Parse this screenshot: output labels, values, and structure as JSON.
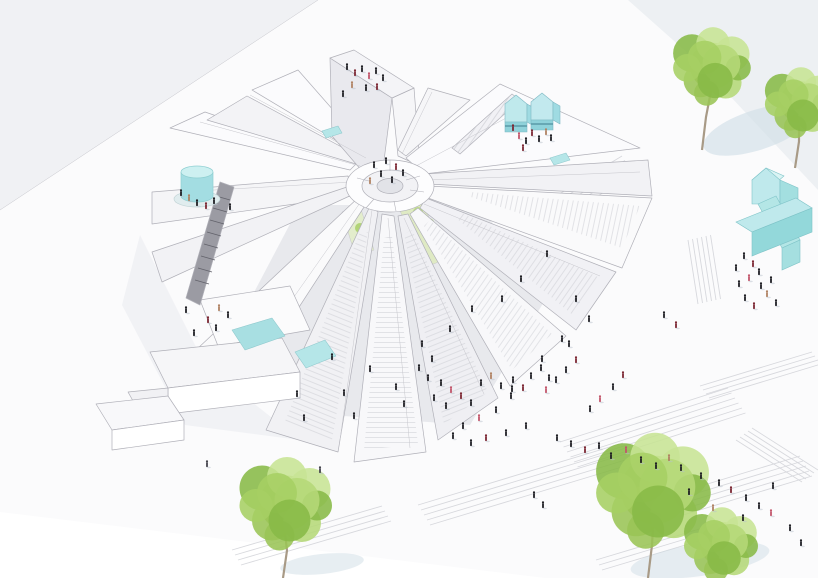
{
  "scene": {
    "description": "axonometric architectural rendering of a radial pavilion building with wedge-shaped stair roofs on a stepped public plaza, cyan rooftop volumes, green trees and scattered tiny people",
    "objects": [
      "radial-building",
      "central-hub",
      "roof-wedges",
      "stair-ramps",
      "cyan-water-tank",
      "cyan-roof-pavilions",
      "cyan-house-volume",
      "cyan-cross-volume",
      "roof-skylight-pools",
      "courtyard-green-strips",
      "plaza-terraced-steps",
      "trees",
      "tree-shadows",
      "people-figures",
      "block-steps",
      "dark-stair"
    ],
    "colors": {
      "background": "#ffffff",
      "ground_tint": "#f0f1f4",
      "ground_tint_right": "#edf0f3",
      "plaza_white": "#ffffff",
      "line": "#b0b0b8",
      "line_soft": "#c6c6cc",
      "step_line": "#d4d5da",
      "wedge_light": "#fbfbfd",
      "wedge_mid": "#f3f3f6",
      "wedge_dark": "#e9e9ee",
      "interior_shadow": "#e4e5ea",
      "accent_cyan": "#bfe9ec",
      "accent_cyan_mid": "#a3dde2",
      "accent_cyan_dark": "#8fd4d8",
      "accent_cyan_deep": "#5f9aa8",
      "pool_cyan": "#a8dfe2",
      "green_strip": "#dcead#",
      "tree_green": "#a6cf63",
      "tree_green_dark": "#88b947",
      "tree_green_light": "#c7e494",
      "trunk": "#a89a86",
      "shadow_blue": "#cfdde6",
      "person_black": "#1f1f24",
      "person_red": "#7c2733",
      "person_pink": "#c2566b",
      "person_tan": "#b08263",
      "person_gray": "#44444c"
    },
    "person_palette": [
      "#1f1f24",
      "#7c2733",
      "#c2566b",
      "#b08263",
      "#44444c"
    ],
    "people": [
      [
        347,
        70,
        0
      ],
      [
        355,
        76,
        1
      ],
      [
        362,
        72,
        0
      ],
      [
        369,
        79,
        2
      ],
      [
        376,
        74,
        0
      ],
      [
        383,
        81,
        0
      ],
      [
        352,
        88,
        3
      ],
      [
        366,
        91,
        0
      ],
      [
        377,
        90,
        1
      ],
      [
        343,
        97,
        0
      ],
      [
        374,
        168,
        0
      ],
      [
        386,
        164,
        0
      ],
      [
        396,
        170,
        1
      ],
      [
        381,
        177,
        0
      ],
      [
        392,
        183,
        0
      ],
      [
        403,
        176,
        0
      ],
      [
        370,
        184,
        3
      ],
      [
        513,
        131,
        1
      ],
      [
        519,
        139,
        2
      ],
      [
        526,
        144,
        0
      ],
      [
        532,
        136,
        1
      ],
      [
        539,
        142,
        0
      ],
      [
        546,
        135,
        3
      ],
      [
        551,
        141,
        0
      ],
      [
        523,
        151,
        1
      ],
      [
        181,
        196,
        0
      ],
      [
        189,
        201,
        3
      ],
      [
        197,
        206,
        0
      ],
      [
        206,
        209,
        1
      ],
      [
        214,
        204,
        0
      ],
      [
        230,
        210,
        0
      ],
      [
        186,
        313,
        0
      ],
      [
        219,
        311,
        3
      ],
      [
        228,
        318,
        0
      ],
      [
        208,
        323,
        1
      ],
      [
        216,
        331,
        0
      ],
      [
        194,
        336,
        0
      ],
      [
        297,
        397,
        0
      ],
      [
        304,
        421,
        0
      ],
      [
        332,
        360,
        0
      ],
      [
        344,
        396,
        0
      ],
      [
        354,
        419,
        0
      ],
      [
        370,
        372,
        0
      ],
      [
        396,
        390,
        0
      ],
      [
        404,
        407,
        0
      ],
      [
        422,
        347,
        0
      ],
      [
        432,
        362,
        0
      ],
      [
        450,
        332,
        0
      ],
      [
        472,
        312,
        0
      ],
      [
        502,
        302,
        0
      ],
      [
        521,
        282,
        0
      ],
      [
        547,
        257,
        0
      ],
      [
        576,
        302,
        0
      ],
      [
        589,
        322,
        0
      ],
      [
        562,
        342,
        0
      ],
      [
        542,
        362,
        0
      ],
      [
        512,
        392,
        0
      ],
      [
        419,
        371,
        0
      ],
      [
        428,
        381,
        0
      ],
      [
        441,
        386,
        0
      ],
      [
        451,
        393,
        2
      ],
      [
        434,
        401,
        0
      ],
      [
        446,
        409,
        0
      ],
      [
        461,
        399,
        1
      ],
      [
        471,
        406,
        0
      ],
      [
        481,
        386,
        0
      ],
      [
        491,
        379,
        3
      ],
      [
        501,
        389,
        0
      ],
      [
        513,
        383,
        0
      ],
      [
        523,
        391,
        1
      ],
      [
        531,
        379,
        0
      ],
      [
        541,
        371,
        0
      ],
      [
        549,
        381,
        0
      ],
      [
        511,
        399,
        0
      ],
      [
        496,
        413,
        0
      ],
      [
        479,
        421,
        2
      ],
      [
        463,
        429,
        0
      ],
      [
        453,
        439,
        0
      ],
      [
        471,
        446,
        0
      ],
      [
        486,
        441,
        1
      ],
      [
        506,
        436,
        0
      ],
      [
        526,
        429,
        0
      ],
      [
        569,
        347,
        0
      ],
      [
        576,
        363,
        1
      ],
      [
        566,
        373,
        0
      ],
      [
        556,
        383,
        0
      ],
      [
        546,
        393,
        2
      ],
      [
        557,
        441,
        0
      ],
      [
        571,
        447,
        0
      ],
      [
        585,
        453,
        1
      ],
      [
        599,
        449,
        0
      ],
      [
        611,
        459,
        0
      ],
      [
        626,
        453,
        2
      ],
      [
        641,
        463,
        0
      ],
      [
        656,
        469,
        0
      ],
      [
        669,
        461,
        3
      ],
      [
        681,
        471,
        0
      ],
      [
        719,
        486,
        0
      ],
      [
        731,
        493,
        1
      ],
      [
        746,
        501,
        0
      ],
      [
        759,
        509,
        0
      ],
      [
        771,
        516,
        2
      ],
      [
        743,
        521,
        0
      ],
      [
        701,
        479,
        0
      ],
      [
        689,
        495,
        0
      ],
      [
        713,
        511,
        3
      ],
      [
        773,
        489,
        0
      ],
      [
        790,
        531,
        0
      ],
      [
        801,
        546,
        0
      ],
      [
        744,
        259,
        0
      ],
      [
        753,
        267,
        1
      ],
      [
        759,
        275,
        0
      ],
      [
        749,
        281,
        2
      ],
      [
        739,
        287,
        0
      ],
      [
        761,
        289,
        0
      ],
      [
        767,
        297,
        3
      ],
      [
        745,
        301,
        0
      ],
      [
        754,
        309,
        1
      ],
      [
        736,
        271,
        0
      ],
      [
        771,
        283,
        0
      ],
      [
        776,
        306,
        0
      ],
      [
        664,
        318,
        0
      ],
      [
        676,
        328,
        1
      ],
      [
        613,
        390,
        0
      ],
      [
        600,
        402,
        2
      ],
      [
        590,
        412,
        0
      ],
      [
        623,
        378,
        1
      ],
      [
        534,
        498,
        0
      ],
      [
        543,
        508,
        0
      ],
      [
        207,
        467,
        4
      ],
      [
        320,
        473,
        4
      ]
    ],
    "trees": [
      {
        "x": 713,
        "y": 70,
        "r": 42,
        "trunk": true,
        "tx": 702,
        "ty": 150,
        "h": 60
      },
      {
        "x": 801,
        "y": 106,
        "r": 38,
        "trunk": true,
        "tx": 795,
        "ty": 168,
        "h": 48
      },
      {
        "x": 287,
        "y": 508,
        "r": 50,
        "trunk": true,
        "tx": 283,
        "ty": 578,
        "h": 50
      },
      {
        "x": 655,
        "y": 496,
        "r": 62,
        "trunk": true,
        "tx": 648,
        "ty": 578,
        "h": 60
      },
      {
        "x": 722,
        "y": 548,
        "r": 40,
        "trunk": false,
        "tx": 0,
        "ty": 0,
        "h": 0
      }
    ],
    "tree_shadows": [
      {
        "x": 757,
        "y": 130,
        "rx": 56,
        "ry": 20,
        "rot": -18,
        "o": 0.6
      },
      {
        "x": 700,
        "y": 560,
        "rx": 70,
        "ry": 16,
        "rot": -8,
        "o": 0.5
      },
      {
        "x": 322,
        "y": 564,
        "rx": 42,
        "ry": 10,
        "rot": -6,
        "o": 0.5
      }
    ],
    "step_groups": [
      {
        "x": 556,
        "y": 196,
        "dx": 66,
        "dy": -40,
        "n": 5,
        "gx": 3,
        "gy": 4.5
      },
      {
        "x": 688,
        "y": 240,
        "dx": 10,
        "dy": 64,
        "n": 6,
        "gx": 4.5,
        "gy": -1
      },
      {
        "x": 700,
        "y": 386,
        "dx": 112,
        "dy": -34,
        "n": 4,
        "gx": 3,
        "gy": 4
      },
      {
        "x": 560,
        "y": 442,
        "dx": 168,
        "dy": -54,
        "n": 6,
        "gx": 3.5,
        "gy": 5
      },
      {
        "x": 418,
        "y": 505,
        "dx": 205,
        "dy": -62,
        "n": 5,
        "gx": 3,
        "gy": 5
      },
      {
        "x": 232,
        "y": 550,
        "dx": 150,
        "dy": -44,
        "n": 4,
        "gx": 3,
        "gy": 5
      },
      {
        "x": 648,
        "y": 502,
        "dx": 152,
        "dy": -46,
        "n": 5,
        "gx": 3,
        "gy": 5
      },
      {
        "x": 752,
        "y": 428,
        "dx": 66,
        "dy": 42,
        "n": 5,
        "gx": -4,
        "gy": 3
      },
      {
        "x": 596,
        "y": 560,
        "dx": 120,
        "dy": -36,
        "n": 3,
        "gx": 3,
        "gy": 5
      }
    ]
  }
}
